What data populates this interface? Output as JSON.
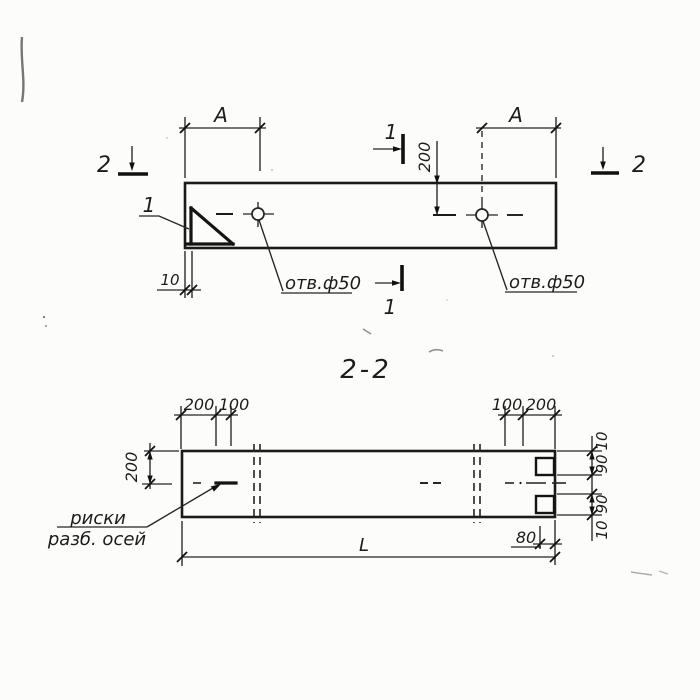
{
  "colors": {
    "ink": "#1c1c1c",
    "paper": "#fcfcfb"
  },
  "plan_view": {
    "dim_a_left": "А",
    "dim_a_right": "А",
    "dim_hole_axis": "200",
    "dim_end_offset": "10",
    "hole_label_left": "отв.ф50",
    "hole_label_right": "отв.ф50",
    "detail_mark": "1",
    "section_1_top": "1",
    "section_1_bottom": "1",
    "section_2_left": "2",
    "section_2_right": "2"
  },
  "section_view": {
    "title": "2-2",
    "dims_top_left": [
      "200",
      "100"
    ],
    "dims_top_right": [
      "100",
      "200"
    ],
    "dim_height_axis": "200",
    "dims_right_chain": [
      "10",
      "90",
      "90",
      "10"
    ],
    "dim_notch_depth": "80",
    "dim_total_length": "L",
    "axis_note_line1": "риски",
    "axis_note_line2": "разб. осей"
  }
}
